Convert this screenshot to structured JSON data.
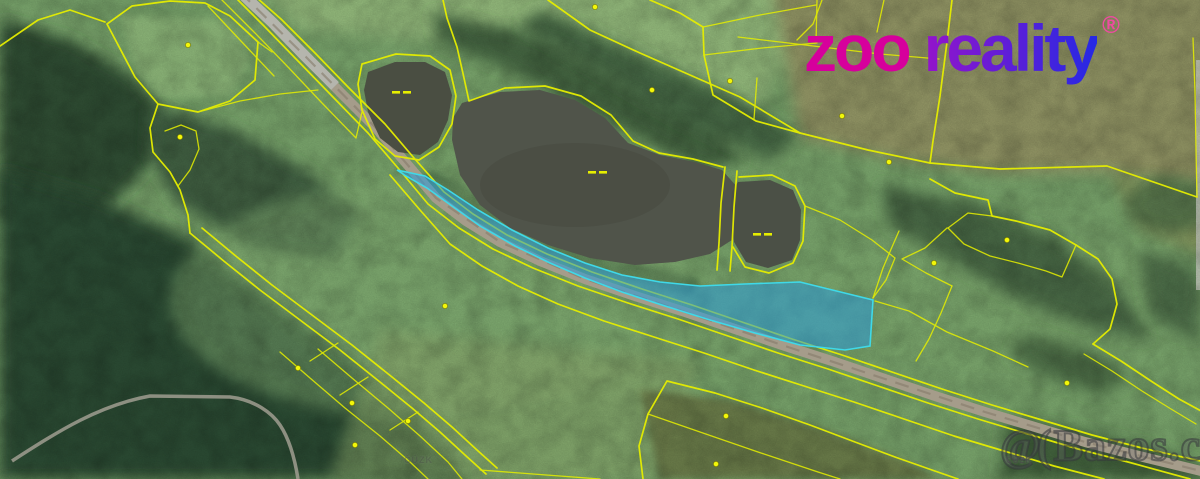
{
  "logo": {
    "zoo": "zoo",
    "reality": "reality",
    "registered": "®",
    "zoo_color": "#d6009c",
    "reality_gradient_start": "#9414cb",
    "reality_gradient_end": "#2529e4",
    "registered_color": "#ee4ba0"
  },
  "watermark": {
    "prefix": "@(",
    "site": "Bazos.cz",
    "source_label_right": "ČÚZK",
    "source_label_center": "ČÚZK"
  },
  "map": {
    "type": "satellite-cadastral",
    "boundary_color": "#e6ee00",
    "highlight_fill": "#2a9ddb",
    "highlight_stroke": "#3fd9e8",
    "features": [
      {
        "name": "main-dirt-road"
      },
      {
        "name": "large-pond"
      },
      {
        "name": "small-pond"
      },
      {
        "name": "east-pond"
      },
      {
        "name": "highlighted-parcel"
      },
      {
        "name": "forest-trail"
      }
    ]
  }
}
